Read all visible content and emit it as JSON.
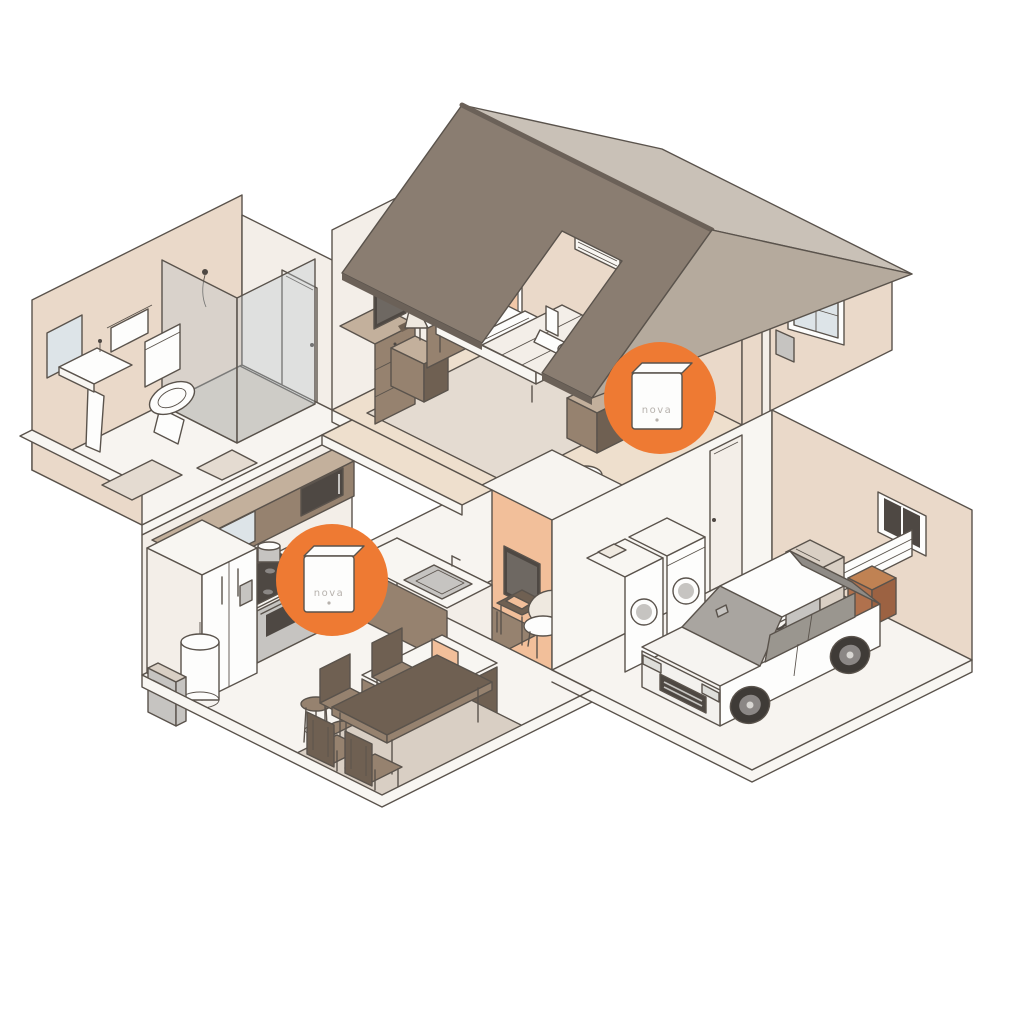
{
  "scene": {
    "title": "isometric-home-wifi-cutaway",
    "devices": [
      {
        "id": "device-bedroom",
        "label": "nova",
        "location": "bedroom"
      },
      {
        "id": "device-kitchen",
        "label": "nova",
        "location": "kitchen"
      }
    ],
    "rooms": [
      "bathroom",
      "bedroom",
      "kitchen",
      "dining-area",
      "living-room",
      "garage"
    ],
    "objects": {
      "bathroom": [
        "mirror",
        "towel",
        "pedestal-sink",
        "toilet",
        "shower",
        "bath-mat"
      ],
      "bedroom": [
        "door",
        "dresser",
        "tv",
        "nightstand",
        "lamp",
        "bed",
        "plant",
        "robot-vacuum",
        "vent"
      ],
      "kitchen": [
        "upper-cabinets",
        "microwave",
        "counter",
        "stove",
        "fridge",
        "sink",
        "island",
        "laptop",
        "bar-stool",
        "water-heater"
      ],
      "dining-area": [
        "table",
        "chair",
        "rug"
      ],
      "living-room": [
        "tv",
        "console",
        "side-table",
        "book",
        "armchair",
        "rug"
      ],
      "garage": [
        "washer",
        "dryer",
        "bicycle",
        "trash-bin",
        "crate",
        "car",
        "garage-door",
        "window"
      ]
    },
    "colors": {
      "accent_orange": "#ee7a33",
      "roof_dark": "#8a7d71",
      "roof_light": "#c9c1b7",
      "roof_mid": "#b5aa9d",
      "roof_edge": "#6b6158",
      "wall_warm": "#ead9c9",
      "wall_light": "#f3eee8",
      "wall_white": "#f8f6f2",
      "floor_peach": "#eedfcd",
      "floor_light": "#f7f4f0",
      "rug": "#e4dbd1",
      "rug_dark": "#d9cfc4",
      "wood_dark": "#6f6052",
      "wood_mid": "#96826f",
      "wood_light": "#c3b09c",
      "steel": "#c6c4c1",
      "dark": "#4e4843",
      "white": "#fdfdfc",
      "cream": "#efe9e0",
      "peach": "#f2bf9a",
      "glass": "#b9c6cd",
      "mirror": "#dde4e8",
      "text_grey": "#b7b2ad",
      "line": "#5a534c"
    }
  }
}
